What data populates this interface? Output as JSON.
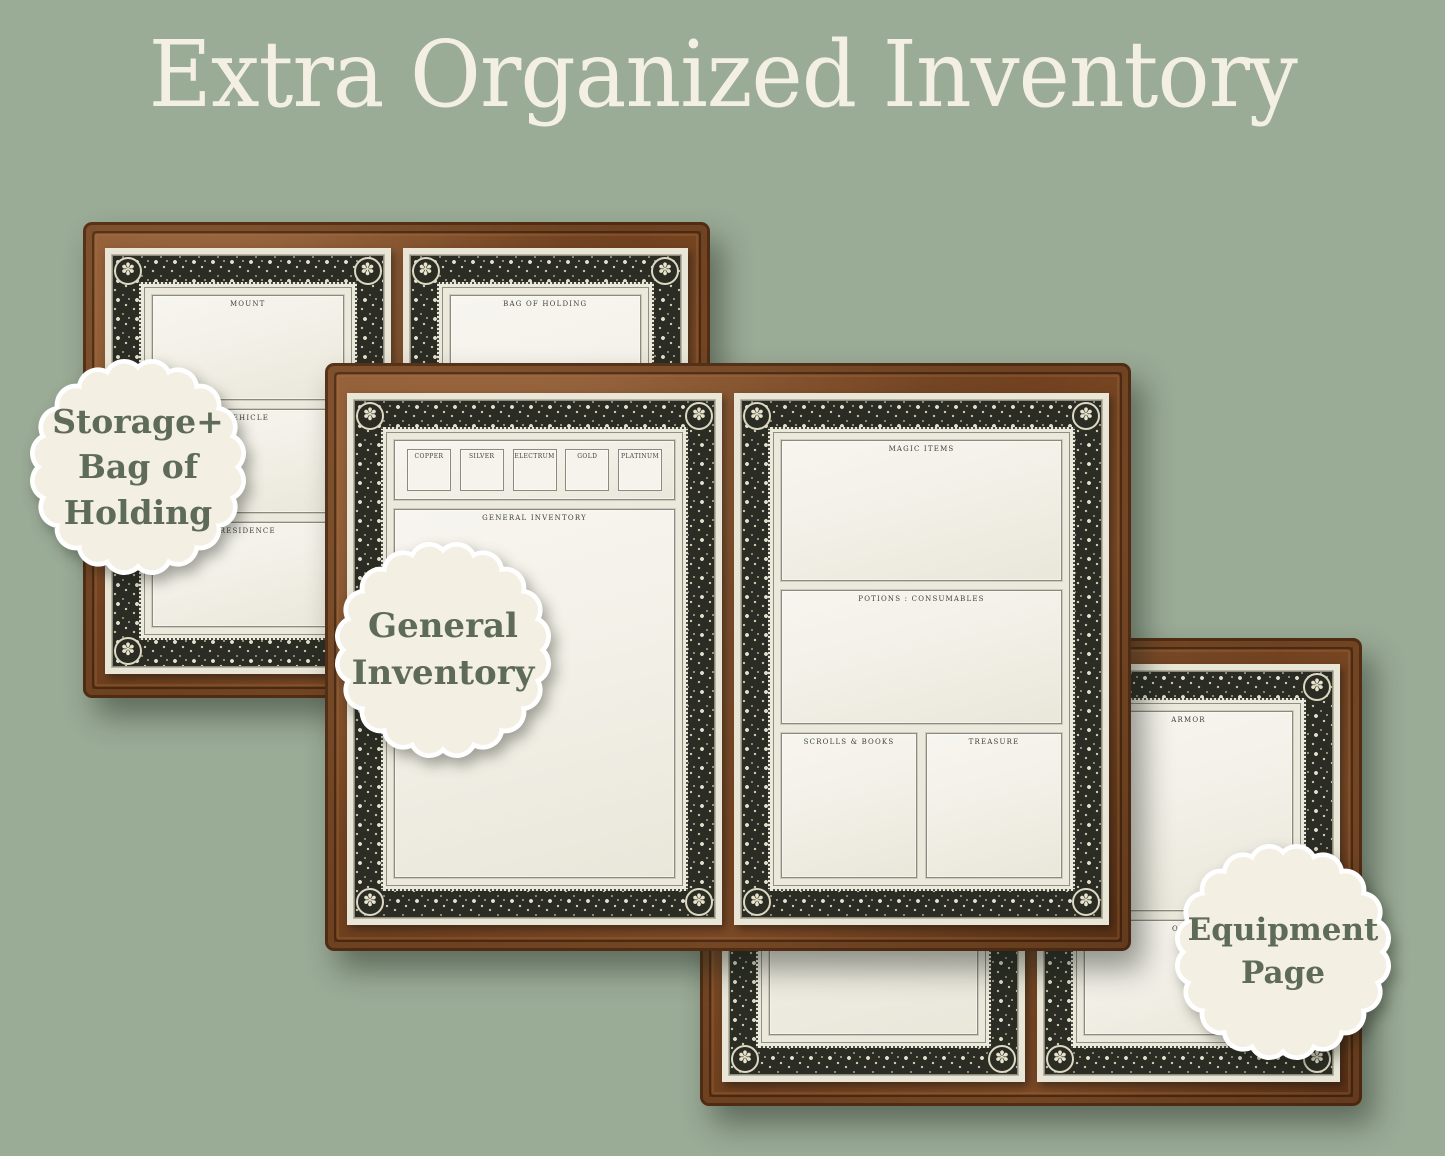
{
  "title": "Extra Organized Inventory",
  "colors": {
    "background": "#9aab96",
    "title_text": "#f3f0e3",
    "badge_background": "#f3efe3",
    "badge_text": "#5e6c57",
    "leather_brown": "#7a4a26",
    "parchment": "#eae7db",
    "ornate_border": "#2b2d24"
  },
  "icons": {
    "rosette": "✽"
  },
  "badges": {
    "storage": {
      "lines": [
        "Storage+",
        "Bag of",
        "Holding"
      ]
    },
    "general": {
      "lines": [
        "General",
        "Inventory"
      ]
    },
    "equipment": {
      "lines": [
        "Equipment",
        "Page"
      ]
    }
  },
  "books": {
    "storage": {
      "left_sections": [
        "MOUNT",
        "VEHICLE",
        "RESIDENCE"
      ],
      "right_sections": [
        "BAG OF HOLDING"
      ]
    },
    "general": {
      "coins": [
        "COPPER",
        "SILVER",
        "ELECTRUM",
        "GOLD",
        "PLATINUM"
      ],
      "main_label": "GENERAL INVENTORY",
      "magic_items": "MAGIC ITEMS",
      "potions": "POTIONS : CONSUMABLES",
      "scrolls": "SCROLLS & BOOKS",
      "treasure": "TREASURE"
    },
    "equipment": {
      "armor": "ARMOR",
      "other": "OTHER"
    }
  }
}
